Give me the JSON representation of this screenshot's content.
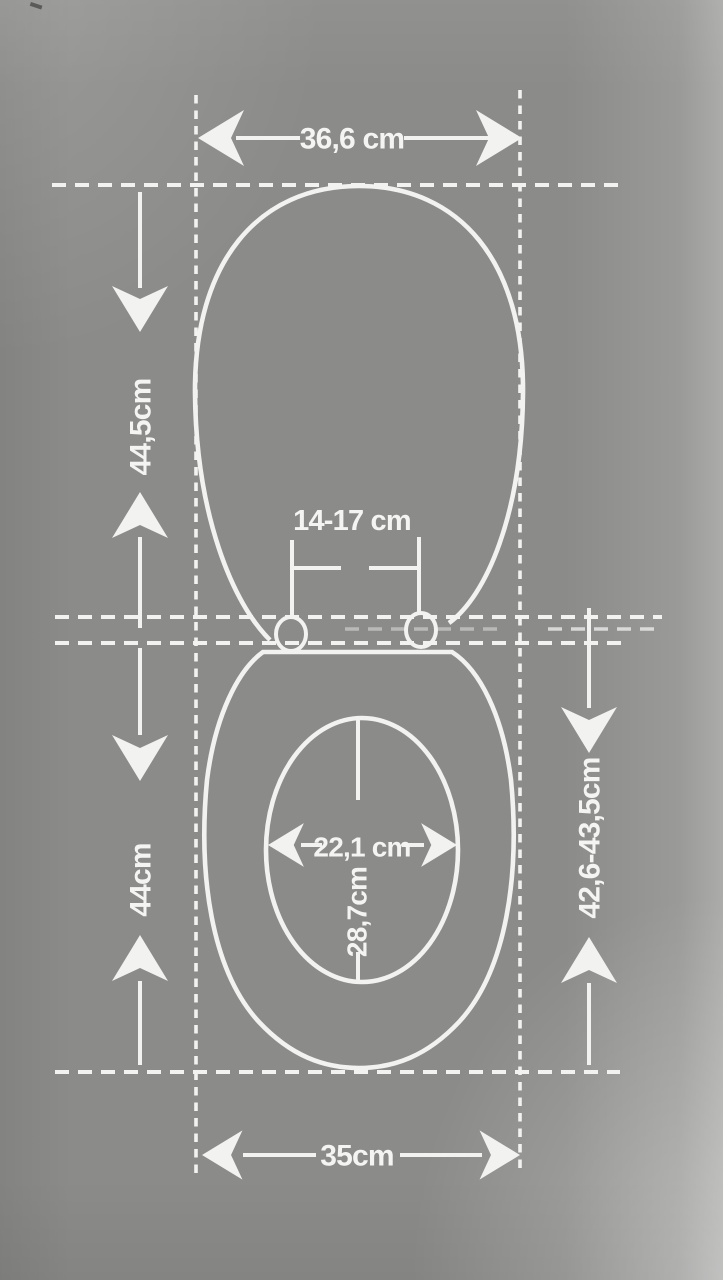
{
  "diagram": {
    "subject": "toilet-seat-dimension-drawing",
    "colors": {
      "background": "#8b8b89",
      "lines": "#f2f2f1",
      "text": "#f4f4f2"
    },
    "labels": {
      "lid_width": "36,6 cm",
      "lid_length": "44,5cm",
      "hinge_distance": "14-17 cm",
      "seat_length": "44cm",
      "mount_length_range": "42,6-43,5cm",
      "inner_width": "22,1 cm",
      "inner_length": "28,7cm",
      "seat_width": "35cm"
    }
  }
}
